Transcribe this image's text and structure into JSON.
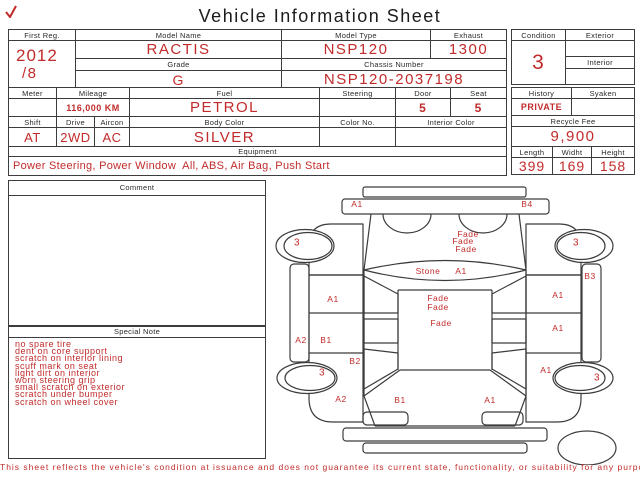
{
  "title": "Vehicle Information Sheet",
  "colors": {
    "accent_red": "#c22b2b",
    "line": "#3c3c3c"
  },
  "vehicle": {
    "first_reg": {
      "label": "First Reg.",
      "line1": "2012",
      "line2": "/8"
    },
    "model_name": {
      "label": "Model Name",
      "value": "RACTIS"
    },
    "model_type": {
      "label": "Model Type",
      "value": "NSP120"
    },
    "exhaust": {
      "label": "Exhaust",
      "value": "1300"
    },
    "grade": {
      "label": "Grade",
      "value": "G"
    },
    "chassis_number": {
      "label": "Chassis Number",
      "value": "NSP120-2037198"
    },
    "condition": {
      "label": "Condition",
      "value": "3"
    },
    "exterior": {
      "label": "Exterior",
      "value": ""
    },
    "interior": {
      "label": "Interior",
      "value": ""
    },
    "meter": {
      "label": "Meter",
      "value": ""
    },
    "mileage": {
      "label": "Mileage",
      "value": "116,000 KM"
    },
    "fuel": {
      "label": "Fuel",
      "value": "PETROL"
    },
    "steering": {
      "label": "Steering",
      "value": ""
    },
    "door": {
      "label": "Door",
      "value": "5"
    },
    "seat": {
      "label": "Seat",
      "value": "5"
    },
    "shift": {
      "label": "Shift",
      "value": "AT"
    },
    "drive": {
      "label": "Drive",
      "value": "2WD"
    },
    "aircon": {
      "label": "Aircon",
      "value": "AC"
    },
    "body_color": {
      "label": "Body Color",
      "value": "SILVER"
    },
    "color_no": {
      "label": "Color No.",
      "value": ""
    },
    "interior_color": {
      "label": "Interior Color",
      "value": ""
    },
    "equipment": {
      "label": "Equipment",
      "value": "Power Steering, Power Window  All, ABS, Air Bag, Push Start"
    },
    "history": {
      "label": "History",
      "value": "PRIVATE"
    },
    "syaken": {
      "label": "Syaken",
      "value": ""
    },
    "recycle_fee": {
      "label": "Recycle Fee",
      "value": "9,900"
    },
    "length": {
      "label": "Length",
      "value": "399"
    },
    "width": {
      "label": "Widht",
      "value": "169"
    },
    "height": {
      "label": "Height",
      "value": "158"
    }
  },
  "comment": {
    "label": "Comment",
    "lines": []
  },
  "special_note": {
    "label": "Special Note",
    "lines": [
      "no spare tire",
      "dent on core support",
      "scratch on interior lining",
      "scuff mark on seat",
      "light dirt on interior",
      "worn steering grip",
      "small scratch on exterior",
      "scratch under bumper",
      "scratch on wheel cover"
    ]
  },
  "damage_map": {
    "labels": [
      {
        "text": "A1",
        "x": 87,
        "y": 22
      },
      {
        "text": "B4",
        "x": 257,
        "y": 22
      },
      {
        "text": "3",
        "x": 27,
        "y": 61
      },
      {
        "text": "3",
        "x": 306,
        "y": 61
      },
      {
        "text": "Fade",
        "x": 198,
        "y": 52
      },
      {
        "text": "Fade",
        "x": 193,
        "y": 59
      },
      {
        "text": "Fade",
        "x": 196,
        "y": 67
      },
      {
        "text": "Stone",
        "x": 158,
        "y": 89
      },
      {
        "text": "A1",
        "x": 191,
        "y": 89
      },
      {
        "text": "B3",
        "x": 320,
        "y": 94
      },
      {
        "text": "A1",
        "x": 63,
        "y": 117
      },
      {
        "text": "A1",
        "x": 288,
        "y": 113
      },
      {
        "text": "Fade",
        "x": 168,
        "y": 116
      },
      {
        "text": "Fade",
        "x": 168,
        "y": 125
      },
      {
        "text": "Fade",
        "x": 171,
        "y": 141
      },
      {
        "text": "A1",
        "x": 288,
        "y": 146
      },
      {
        "text": "A2",
        "x": 31,
        "y": 158
      },
      {
        "text": "B1",
        "x": 56,
        "y": 158
      },
      {
        "text": "B2",
        "x": 85,
        "y": 179
      },
      {
        "text": "3",
        "x": 52,
        "y": 191
      },
      {
        "text": "A1",
        "x": 276,
        "y": 188
      },
      {
        "text": "3",
        "x": 327,
        "y": 196
      },
      {
        "text": "A2",
        "x": 71,
        "y": 217
      },
      {
        "text": "B1",
        "x": 130,
        "y": 218
      },
      {
        "text": "A1",
        "x": 220,
        "y": 218
      }
    ]
  },
  "footer": "This sheet reflects the vehicle's condition at issuance and does not guarantee its current state, functionality, or suitability for any purpose"
}
